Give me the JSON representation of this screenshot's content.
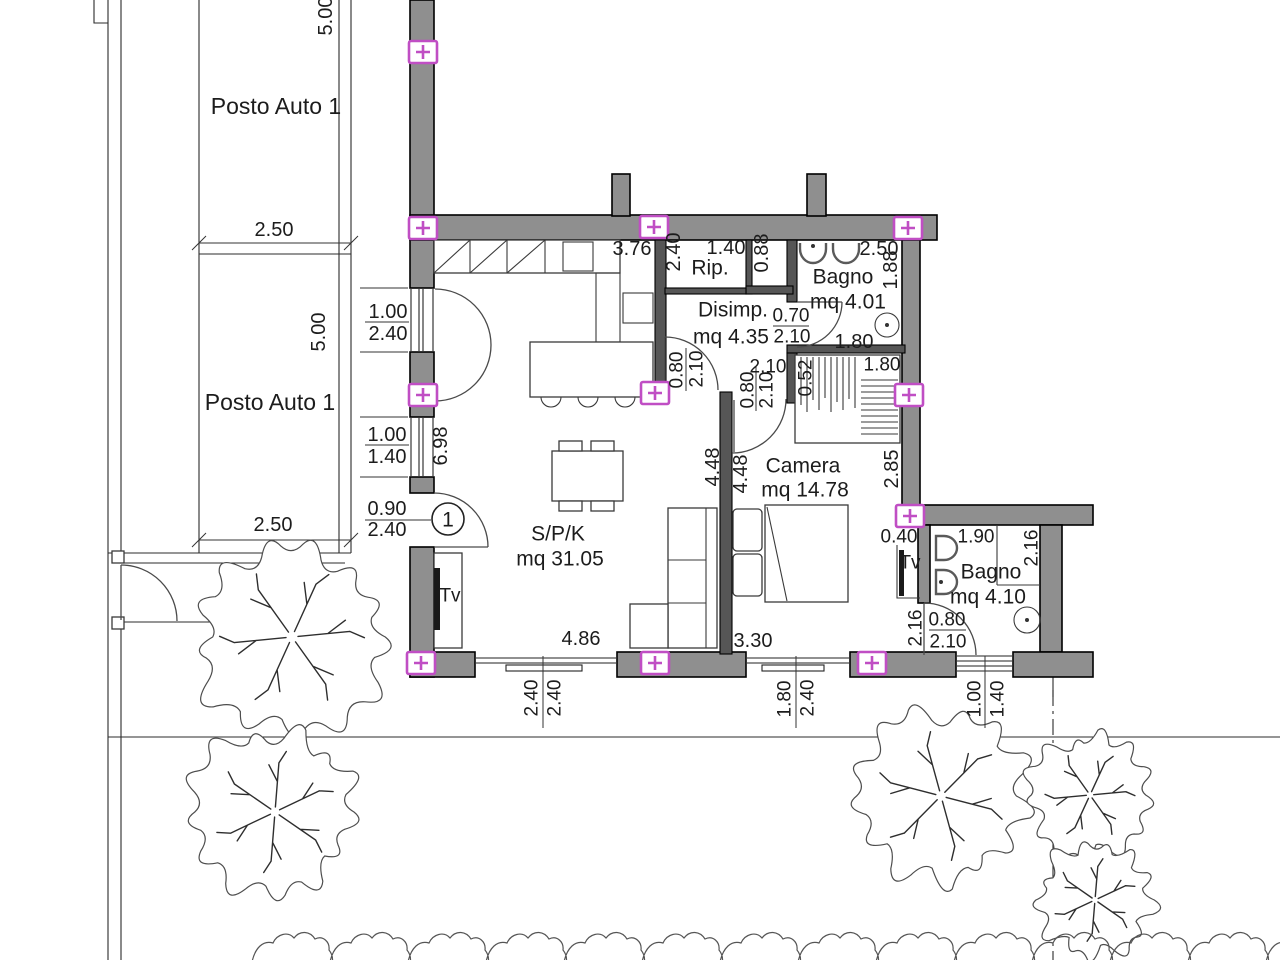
{
  "plan": {
    "unit_badge": "1",
    "rooms": [
      {
        "name": "S/P/K",
        "area": "mq 31.05"
      },
      {
        "name": "Camera",
        "area": "mq 14.78"
      },
      {
        "name": "Bagno",
        "area": "mq 4.01"
      },
      {
        "name": "Bagno",
        "area": "mq 4.10"
      },
      {
        "name": "Disimp.",
        "area": "mq 4.35"
      },
      {
        "name": "Rip.",
        "area": ""
      }
    ],
    "parking_labels": [
      "Posto Auto 1",
      "Posto Auto 1"
    ],
    "tv_labels": [
      "Tv",
      "Tv"
    ]
  },
  "colors": {
    "wall_fill": "#8f8f8f",
    "partition_fill": "#565656",
    "outlet": "#c04ec4",
    "text": "#1c1c1c"
  },
  "outlets": [
    [
      423,
      52
    ],
    [
      423,
      228
    ],
    [
      654,
      227
    ],
    [
      908,
      228
    ],
    [
      423,
      395
    ],
    [
      655,
      393
    ],
    [
      909,
      395
    ],
    [
      910,
      516
    ],
    [
      421,
      663
    ],
    [
      655,
      663
    ],
    [
      872,
      663
    ]
  ],
  "texts": [
    {
      "id": "posto-auto-1a",
      "text": "Posto Auto 1",
      "x": 276,
      "y": 106,
      "size": 23
    },
    {
      "id": "posto-auto-1b",
      "text": "Posto Auto 1",
      "x": 270,
      "y": 402,
      "size": 23
    },
    {
      "id": "dim-5-00-a",
      "text": "5.00",
      "x": 325,
      "y": 16,
      "rot": -90
    },
    {
      "id": "dim-2-50-a",
      "text": "2.50",
      "x": 274,
      "y": 229
    },
    {
      "id": "dim-5-00-b",
      "text": "5.00",
      "x": 318,
      "y": 332,
      "rot": -90
    },
    {
      "id": "dim-2-50-b",
      "text": "2.50",
      "x": 273,
      "y": 524
    },
    {
      "id": "dim-1-00-a",
      "text": "1.00",
      "x": 388,
      "y": 311
    },
    {
      "id": "dim-2-40-a",
      "text": "2.40",
      "x": 388,
      "y": 333
    },
    {
      "id": "dim-6-98",
      "text": "6.98",
      "x": 440,
      "y": 446,
      "rot": -90
    },
    {
      "id": "dim-1-00-b",
      "text": "1.00",
      "x": 387,
      "y": 434
    },
    {
      "id": "dim-1-40-a",
      "text": "1.40",
      "x": 387,
      "y": 456
    },
    {
      "id": "dim-0-90",
      "text": "0.90",
      "x": 387,
      "y": 508
    },
    {
      "id": "dim-2-40-b",
      "text": "2.40",
      "x": 387,
      "y": 529
    },
    {
      "id": "unit-badge",
      "text": "1",
      "x": 448,
      "y": 519,
      "size": 21
    },
    {
      "id": "dim-3-76",
      "text": "3.76",
      "x": 632,
      "y": 248
    },
    {
      "id": "dim-2-40-c",
      "text": "2.40",
      "x": 673,
      "y": 252,
      "rot": -90
    },
    {
      "id": "dim-1-40-b",
      "text": "1.40",
      "x": 726,
      "y": 247
    },
    {
      "id": "room-rip",
      "text": "Rip.",
      "x": 710,
      "y": 267,
      "size": 21
    },
    {
      "id": "dim-0-88",
      "text": "0.88",
      "x": 761,
      "y": 253,
      "rot": -90
    },
    {
      "id": "dim-2-50-c",
      "text": "2.50",
      "x": 879,
      "y": 248
    },
    {
      "id": "room-bagno1",
      "text": "Bagno",
      "x": 843,
      "y": 276,
      "size": 21
    },
    {
      "id": "dim-1-88",
      "text": "1.88",
      "x": 890,
      "y": 270,
      "rot": -90
    },
    {
      "id": "room-bagno1-area",
      "text": "mq 4.01",
      "x": 848,
      "y": 301,
      "size": 21
    },
    {
      "id": "room-disimp",
      "text": "Disimp.",
      "x": 733,
      "y": 309,
      "size": 21
    },
    {
      "id": "dim-0-70",
      "text": "0.70",
      "x": 791,
      "y": 315,
      "size": 19
    },
    {
      "id": "dim-2-10-a",
      "text": "2.10",
      "x": 792,
      "y": 336,
      "size": 19
    },
    {
      "id": "room-disimp-area",
      "text": "mq 4.35",
      "x": 731,
      "y": 336,
      "size": 21
    },
    {
      "id": "dim-1-80-a",
      "text": "1.80",
      "x": 854,
      "y": 341
    },
    {
      "id": "dim-2-10-b",
      "text": "2.10",
      "x": 768,
      "y": 366,
      "size": 19
    },
    {
      "id": "dim-0-52",
      "text": "0.52",
      "x": 805,
      "y": 378,
      "rot": -90,
      "size": 19
    },
    {
      "id": "dim-1-80-b",
      "text": "1.80",
      "x": 882,
      "y": 364,
      "size": 19
    },
    {
      "id": "dim-0-80-a",
      "text": "0.80",
      "x": 676,
      "y": 370,
      "rot": -90,
      "size": 19
    },
    {
      "id": "dim-2-10-c",
      "text": "2.10",
      "x": 696,
      "y": 369,
      "rot": -90,
      "size": 19
    },
    {
      "id": "dim-0-80-b",
      "text": "0.80",
      "x": 747,
      "y": 390,
      "rot": -90,
      "size": 19
    },
    {
      "id": "dim-2-10-d",
      "text": "2.10",
      "x": 766,
      "y": 390,
      "rot": -90,
      "size": 19
    },
    {
      "id": "room-camera",
      "text": "Camera",
      "x": 803,
      "y": 465,
      "size": 21
    },
    {
      "id": "room-camera-area",
      "text": "mq 14.78",
      "x": 805,
      "y": 489,
      "size": 21
    },
    {
      "id": "dim-4-48-a",
      "text": "4.48",
      "x": 712,
      "y": 467,
      "rot": -90
    },
    {
      "id": "dim-4-48-b",
      "text": "4.48",
      "x": 740,
      "y": 474,
      "rot": -90
    },
    {
      "id": "dim-2-85",
      "text": "2.85",
      "x": 891,
      "y": 469,
      "rot": -90
    },
    {
      "id": "dim-0-40",
      "text": "0.40",
      "x": 899,
      "y": 536,
      "size": 19
    },
    {
      "id": "tv-camera",
      "text": "Tv",
      "x": 910,
      "y": 562,
      "size": 19
    },
    {
      "id": "dim-1-90",
      "text": "1.90",
      "x": 976,
      "y": 536,
      "size": 19
    },
    {
      "id": "dim-2-16-a",
      "text": "2.16",
      "x": 1031,
      "y": 548,
      "rot": -90,
      "size": 19
    },
    {
      "id": "room-bagno2",
      "text": "Bagno",
      "x": 991,
      "y": 571,
      "size": 21
    },
    {
      "id": "room-bagno2-area",
      "text": "mq 4.10",
      "x": 988,
      "y": 596,
      "size": 21
    },
    {
      "id": "dim-2-16-b",
      "text": "2.16",
      "x": 915,
      "y": 628,
      "rot": -90,
      "size": 19
    },
    {
      "id": "dim-0-80-c",
      "text": "0.80",
      "x": 947,
      "y": 619,
      "size": 19
    },
    {
      "id": "dim-2-10-e",
      "text": "2.10",
      "x": 948,
      "y": 641,
      "size": 19
    },
    {
      "id": "room-spk",
      "text": "S/P/K",
      "x": 558,
      "y": 533,
      "size": 21
    },
    {
      "id": "room-spk-area",
      "text": "mq 31.05",
      "x": 560,
      "y": 558,
      "size": 21
    },
    {
      "id": "tv-spk",
      "text": "Tv",
      "x": 450,
      "y": 595,
      "size": 19
    },
    {
      "id": "dim-4-86",
      "text": "4.86",
      "x": 581,
      "y": 638
    },
    {
      "id": "dim-3-30",
      "text": "3.30",
      "x": 753,
      "y": 640
    },
    {
      "id": "dim-2-40-d",
      "text": "2.40",
      "x": 531,
      "y": 698,
      "rot": -90,
      "size": 19
    },
    {
      "id": "dim-2-40-e",
      "text": "2.40",
      "x": 554,
      "y": 698,
      "rot": -90,
      "size": 19
    },
    {
      "id": "dim-1-80-c",
      "text": "1.80",
      "x": 784,
      "y": 699,
      "rot": -90,
      "size": 19
    },
    {
      "id": "dim-2-40-f",
      "text": "2.40",
      "x": 807,
      "y": 698,
      "rot": -90,
      "size": 19
    },
    {
      "id": "dim-1-00-c",
      "text": "1.00",
      "x": 974,
      "y": 699,
      "rot": -90,
      "size": 19
    },
    {
      "id": "dim-1-40-c",
      "text": "1.40",
      "x": 997,
      "y": 699,
      "rot": -90,
      "size": 19
    }
  ]
}
